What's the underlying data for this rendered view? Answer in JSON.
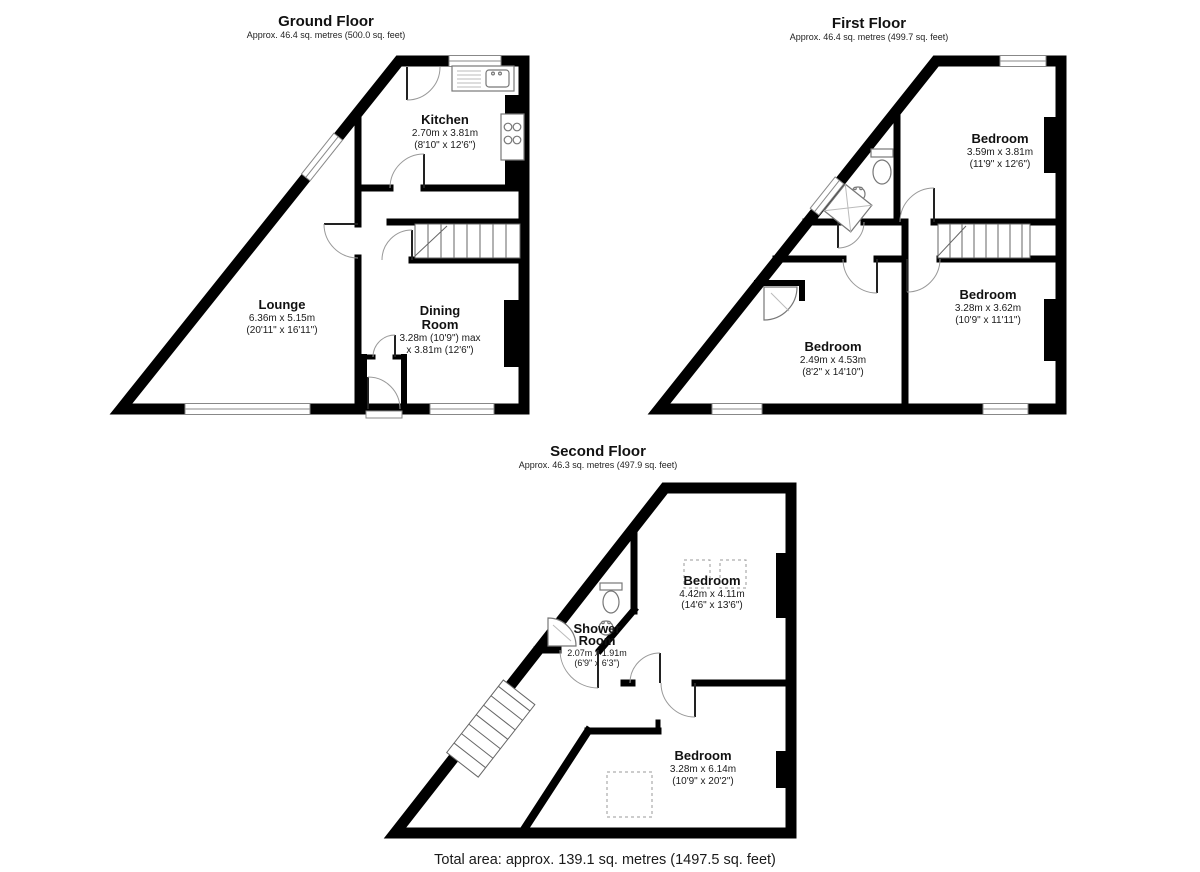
{
  "floors": [
    {
      "title": "Ground Floor",
      "subtitle": "Approx. 46.4 sq. metres (500.0 sq. feet)",
      "rooms": [
        {
          "name": "Kitchen",
          "d1": "2.70m x 3.81m",
          "d2": "(8'10\" x 12'6\")"
        },
        {
          "name": "Lounge",
          "d1": "6.36m x 5.15m",
          "d2": "(20'11\" x 16'11\")"
        },
        {
          "name": "Dining",
          "name2": "Room",
          "d1": "3.28m (10'9\") max",
          "d2": "x 3.81m (12'6\")"
        }
      ]
    },
    {
      "title": "First Floor",
      "subtitle": "Approx. 46.4 sq. metres (499.7 sq. feet)",
      "rooms": [
        {
          "name": "Bedroom",
          "d1": "3.59m x 3.81m",
          "d2": "(11'9\" x 12'6\")"
        },
        {
          "name": "Bedroom",
          "d1": "3.28m x 3.62m",
          "d2": "(10'9\" x 11'11\")"
        },
        {
          "name": "Bedroom",
          "d1": "2.49m x 4.53m",
          "d2": "(8'2\" x 14'10\")"
        }
      ]
    },
    {
      "title": "Second Floor",
      "subtitle": "Approx. 46.3 sq. metres (497.9 sq. feet)",
      "rooms": [
        {
          "name": "Bedroom",
          "d1": "4.42m x 4.11m",
          "d2": "(14'6\" x 13'6\")"
        },
        {
          "name": "Shower",
          "name2": "Room",
          "d1": "2.07m x 1.91m",
          "d2": "(6'9\" x 6'3\")"
        },
        {
          "name": "Bedroom",
          "d1": "3.28m x 6.14m",
          "d2": "(10'9\" x 20'2\")"
        }
      ]
    }
  ],
  "footer": {
    "total_area": "Total area: approx. 139.1 sq. metres (1497.5 sq. feet)"
  }
}
